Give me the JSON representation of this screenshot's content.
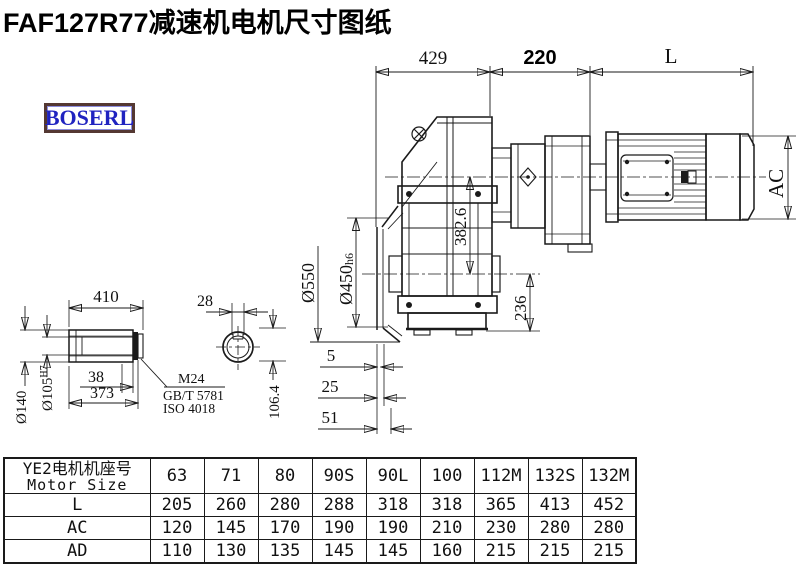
{
  "title": "FAF127R77减速机电机尺寸图纸",
  "logo": "BOSERL",
  "colors": {
    "line": "#1a1a1a",
    "logo_text": "#2023c0",
    "logo_border": "#543832"
  },
  "drawing": {
    "dims": {
      "top_429": "429",
      "top_220": "220",
      "top_L": "L",
      "ac": "AC",
      "v382": "382.6",
      "v236": "236",
      "d550": "Ø550",
      "d450": "Ø450",
      "d450_suffix": "h6",
      "shaft_410": "410",
      "d140": "Ø140",
      "d105": "Ø105",
      "d105_sup": "H7",
      "s38": "38",
      "s373": "373",
      "callout_m24": "M24",
      "callout_gbt": "GB/T 5781",
      "callout_iso": "ISO 4018",
      "key_28": "28",
      "key_106": "106.4",
      "gap_5": "5",
      "gap_25": "25",
      "gap_51": "51"
    }
  },
  "table": {
    "header_cn": "YE2电机机座号",
    "header_en": "Motor Size",
    "columns": [
      "63",
      "71",
      "80",
      "90S",
      "90L",
      "100",
      "112M",
      "132S",
      "132M"
    ],
    "rows": [
      {
        "label": "L",
        "values": [
          "205",
          "260",
          "280",
          "288",
          "318",
          "318",
          "365",
          "413",
          "452"
        ]
      },
      {
        "label": "AC",
        "values": [
          "120",
          "145",
          "170",
          "190",
          "190",
          "210",
          "230",
          "280",
          "280"
        ]
      },
      {
        "label": "AD",
        "values": [
          "110",
          "130",
          "135",
          "145",
          "145",
          "160",
          "215",
          "215",
          "215"
        ]
      }
    ]
  }
}
